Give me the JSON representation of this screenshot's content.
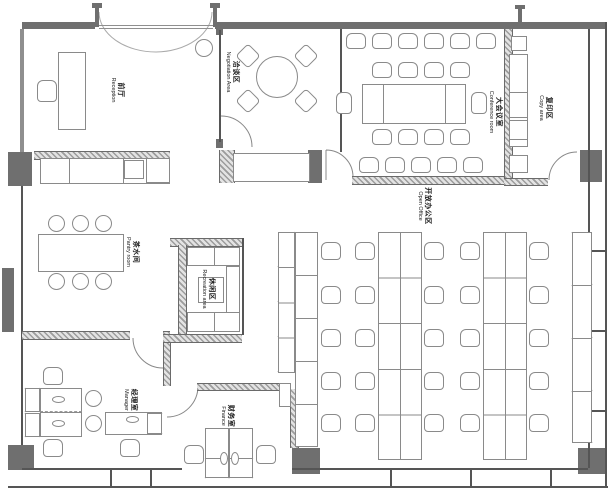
{
  "plan": {
    "rooms": {
      "reception": {
        "zh": "前厅",
        "en": "Reception"
      },
      "negotiation": {
        "zh": "洽谈区",
        "en": "Negotiation Area"
      },
      "conference": {
        "zh": "大会议室",
        "en": "Conference room"
      },
      "copy": {
        "zh": "复印区",
        "en": "Copy area"
      },
      "open_office": {
        "zh": "开放办公区",
        "en": "Open Office"
      },
      "pantry": {
        "zh": "茶水间",
        "en": "Pantry room"
      },
      "recreation": {
        "zh": "休闲区",
        "en": "Recreation area"
      },
      "manager": {
        "zh": "经理室",
        "en": "Manager"
      },
      "finance": {
        "zh": "财务室",
        "en": "Finance"
      }
    },
    "colors": {
      "wall": "#6f6f6f",
      "line": "#555555",
      "furniture": "#8a8a8a",
      "text": "#222222"
    }
  }
}
